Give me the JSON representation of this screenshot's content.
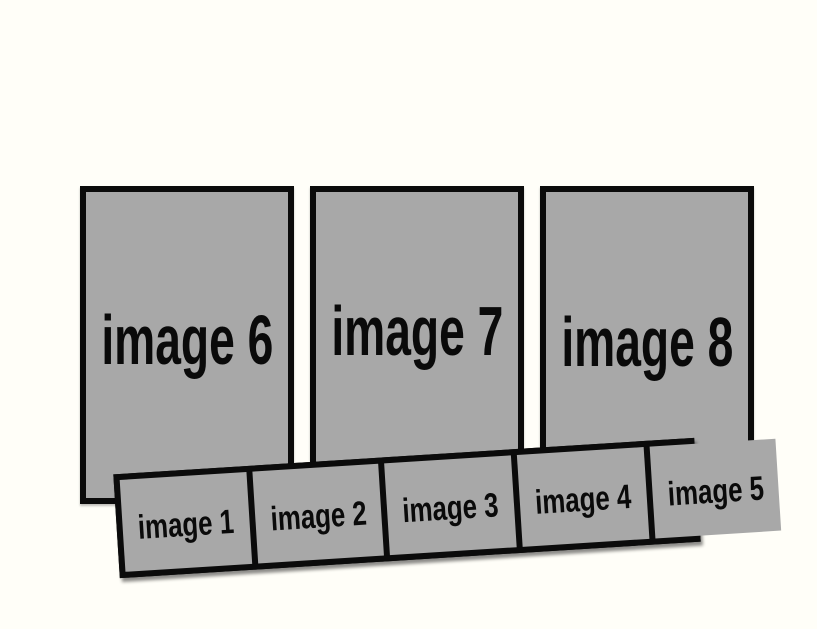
{
  "theme": {
    "background": "#fffef8",
    "placeholder_fill": "#a8a8a8",
    "border_color": "#0b0b0b",
    "text_color": "#0a0a0a"
  },
  "placeholders": {
    "large": [
      {
        "label": "image 6"
      },
      {
        "label": "image 7"
      },
      {
        "label": "image 8"
      }
    ],
    "strip": [
      {
        "label": "image 1"
      },
      {
        "label": "image 2"
      },
      {
        "label": "image 3"
      },
      {
        "label": "image 4"
      },
      {
        "label": "image 5"
      }
    ]
  }
}
